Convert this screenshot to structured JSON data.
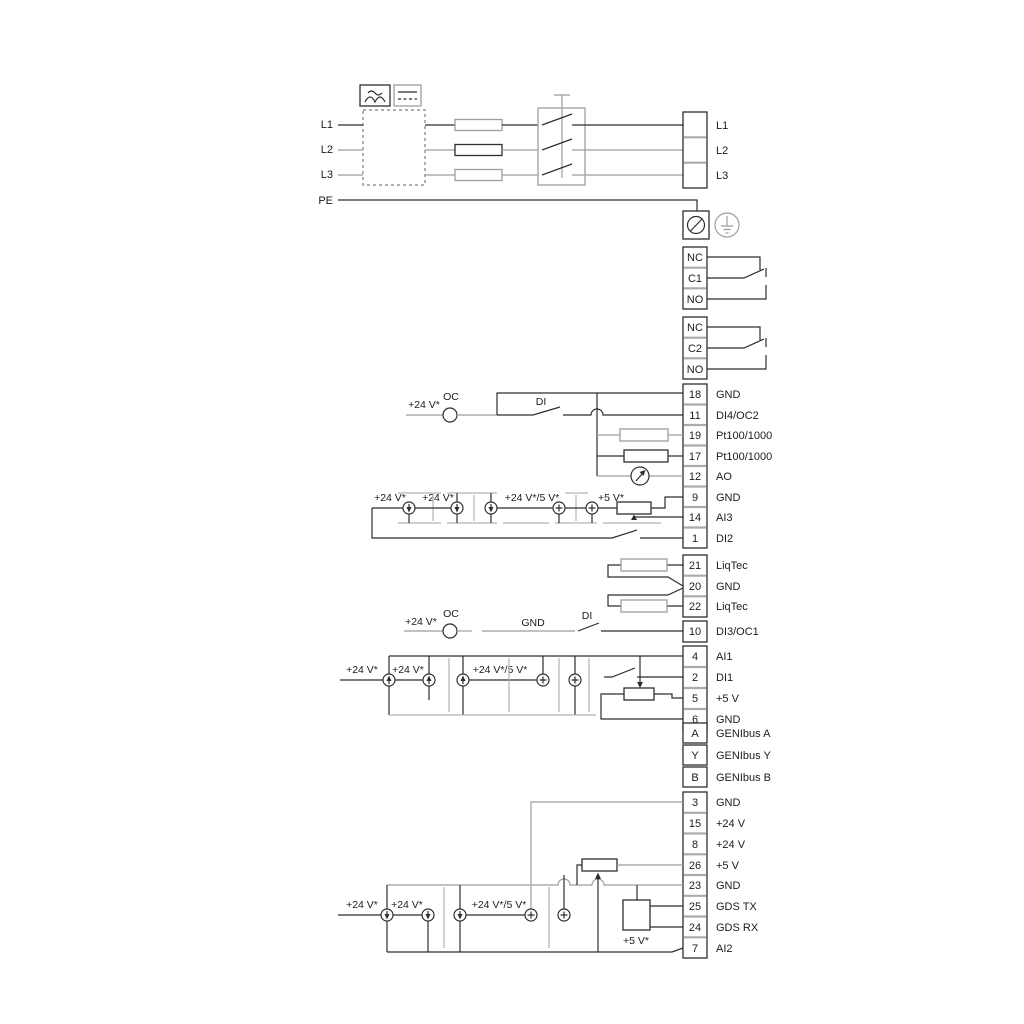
{
  "power": {
    "in": [
      "L1",
      "L2",
      "L3",
      "PE"
    ],
    "out": [
      "L1",
      "L2",
      "L3"
    ]
  },
  "relays": {
    "r1": [
      "NC",
      "C1",
      "NO"
    ],
    "r2": [
      "NC",
      "C2",
      "NO"
    ]
  },
  "blocks": {
    "main": [
      {
        "id": "18",
        "label": "GND"
      },
      {
        "id": "11",
        "label": "DI4/OC2"
      },
      {
        "id": "19",
        "label": "Pt100/1000"
      },
      {
        "id": "17",
        "label": "Pt100/1000"
      },
      {
        "id": "12",
        "label": "AO"
      },
      {
        "id": "9",
        "label": "GND"
      },
      {
        "id": "14",
        "label": "AI3"
      },
      {
        "id": "1",
        "label": "DI2"
      }
    ],
    "liqtec": [
      {
        "id": "21",
        "label": "LiqTec"
      },
      {
        "id": "20",
        "label": "GND"
      },
      {
        "id": "22",
        "label": "LiqTec"
      }
    ],
    "io2": [
      {
        "id": "10",
        "label": "DI3/OC1"
      },
      {
        "id": "4",
        "label": "AI1"
      },
      {
        "id": "2",
        "label": "DI1"
      },
      {
        "id": "5",
        "label": "+5 V"
      },
      {
        "id": "6",
        "label": "GND"
      }
    ],
    "genibus": [
      {
        "id": "A",
        "label": "GENIbus A"
      },
      {
        "id": "Y",
        "label": "GENIbus Y"
      },
      {
        "id": "B",
        "label": "GENIbus B"
      }
    ],
    "bottom": [
      {
        "id": "3",
        "label": "GND"
      },
      {
        "id": "15",
        "label": "+24 V"
      },
      {
        "id": "8",
        "label": "+24 V"
      },
      {
        "id": "26",
        "label": "+5 V"
      },
      {
        "id": "23",
        "label": "GND"
      },
      {
        "id": "25",
        "label": "GDS TX"
      },
      {
        "id": "24",
        "label": "GDS RX"
      },
      {
        "id": "7",
        "label": "AI2"
      }
    ]
  },
  "ann": {
    "row11": {
      "v24": "+24 V*",
      "oc": "OC",
      "di": "DI"
    },
    "ai3": {
      "v24a": "+24 V*",
      "v24b": "+24 V*",
      "v245": "+24 V*/5 V*",
      "v5": "+5 V*"
    },
    "row10": {
      "v24": "+24 V*",
      "oc": "OC",
      "gnd": "GND",
      "di": "DI"
    },
    "ai1": {
      "v24a": "+24 V*",
      "v24b": "+24 V*",
      "v245": "+24 V*/5 V*"
    },
    "ai2": {
      "v24a": "+24 V*",
      "v24b": "+24 V*",
      "v245": "+24 V*/5 V*",
      "v5": "+5 V*"
    }
  },
  "colors": {
    "wire_dark": "#2e2e2e",
    "wire_gray": "#9e9e9e",
    "text": "#1c1c1c",
    "background": "#ffffff"
  }
}
